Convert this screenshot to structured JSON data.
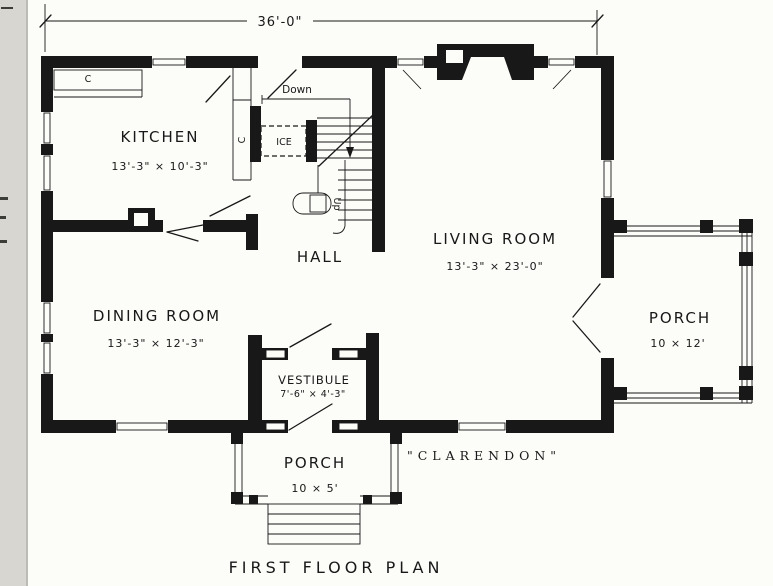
{
  "drawing": {
    "title": "FIRST FLOOR PLAN",
    "house_name": "\"CLARENDON\"",
    "overall_width": "36'-0\""
  },
  "rooms": {
    "kitchen": {
      "name": "KITCHEN",
      "dims": "13'-3\" × 10'-3\""
    },
    "hall": {
      "name": "HALL"
    },
    "living_room": {
      "name": "LIVING ROOM",
      "dims": "13'-3\" × 23'-0\""
    },
    "dining_room": {
      "name": "DINING ROOM",
      "dims": "13'-3\" × 12'-3\""
    },
    "vestibule": {
      "name": "VESTIBULE",
      "dims": "7'-6\" × 4'-3\""
    },
    "front_porch": {
      "name": "PORCH",
      "dims": "10 × 5'"
    },
    "side_porch": {
      "name": "PORCH",
      "dims": "10 × 12'"
    }
  },
  "annotations": {
    "stair_down": "Down",
    "stair_up": "Up",
    "ice_box": "ICE",
    "closet": "C",
    "kitchen_case": "C"
  },
  "colors": {
    "ink": "#181818",
    "paper": "#fcfcf9",
    "scan_edge": "#d7d6d1"
  }
}
